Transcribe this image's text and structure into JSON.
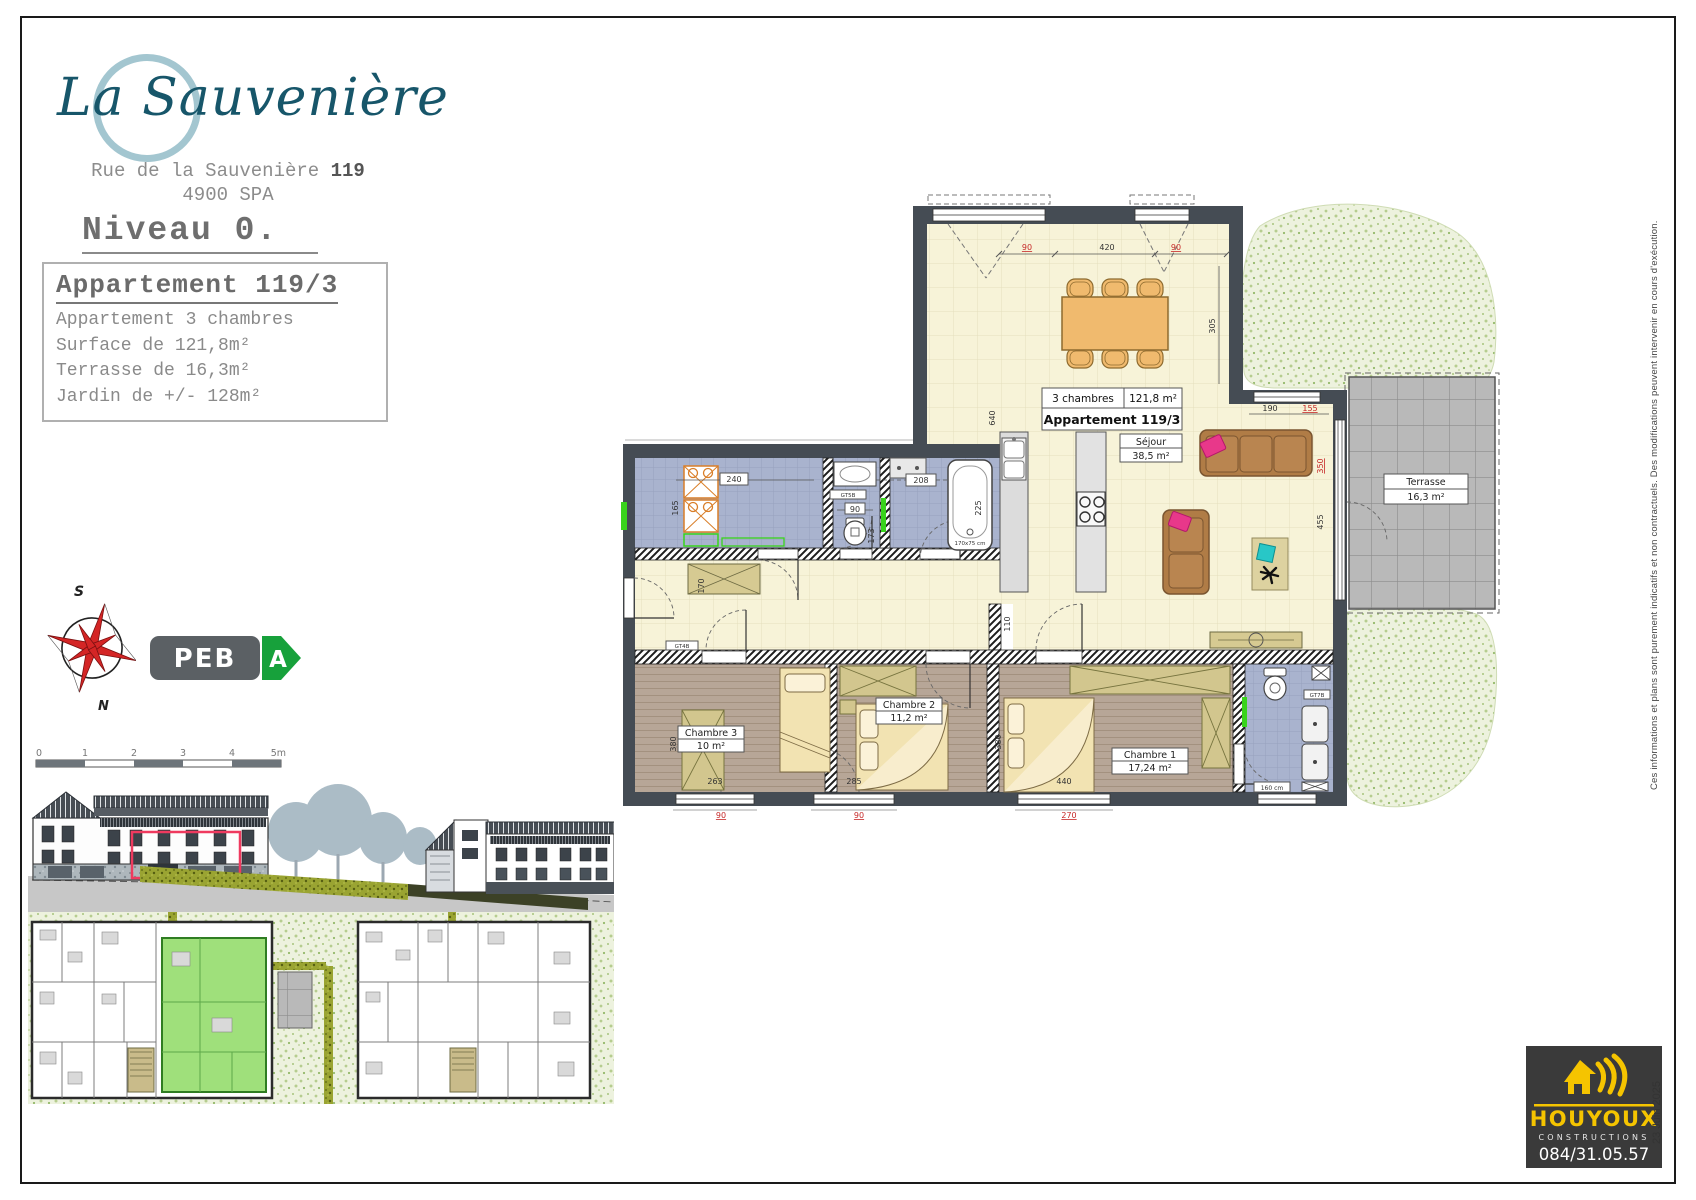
{
  "header": {
    "logo_prefix": "La",
    "logo_suffix": " Sauvenière",
    "address_prefix": "Rue de la Sauvenière ",
    "address_number": "119",
    "address_city": "4900 SPA",
    "level": "Niveau 0."
  },
  "info_box": {
    "title": "Appartement 119/3",
    "line1": "Appartement 3 chambres",
    "line2": "Surface de 121,8m²",
    "line3": "Terrasse de 16,3m²",
    "line4": "Jardin de +/- 128m²"
  },
  "compass": {
    "south": "S",
    "north": "N"
  },
  "peb": {
    "label": "PEB",
    "grade": "A"
  },
  "scale_bar": {
    "t0": "0",
    "t1": "1",
    "t2": "2",
    "t3": "3",
    "t4": "4",
    "t5": "5m"
  },
  "plan": {
    "apartment_box": {
      "type": "3 chambres",
      "area": "121,8 m²",
      "name": "Appartement 119/3"
    },
    "rooms": {
      "sejour": {
        "name": "Séjour",
        "area": "38,5 m²"
      },
      "chambre1": {
        "name": "Chambre 1",
        "area": "17,24 m²"
      },
      "chambre2": {
        "name": "Chambre 2",
        "area": "11,2 m²"
      },
      "chambre3": {
        "name": "Chambre 3",
        "area": "10 m²"
      },
      "terrasse": {
        "name": "Terrasse",
        "area": "16,3 m²"
      }
    },
    "dims": {
      "top_90a": "90",
      "top_420": "420",
      "top_90b": "90",
      "right_305": "305",
      "kitchen_640": "640",
      "laundry_240": "240",
      "laundry_165": "165",
      "wc_90": "90",
      "wc_173": "173",
      "bath_208": "208",
      "bath_225": "225",
      "bath_size": "170x75 cm",
      "hall_170": "170",
      "hall_110": "110",
      "win_190": "190",
      "win_155": "155",
      "glass_350": "350",
      "glass_455": "455",
      "c3_380": "380",
      "c1_380": "380",
      "bottom_263": "263",
      "bottom_90a": "90",
      "bottom_285": "285",
      "bottom_90b": "90",
      "bottom_440": "440",
      "bottom_270": "270",
      "bath2_160": "160 cm"
    },
    "tags": {
      "gt5b": "GT5B",
      "gt4b": "GT4B",
      "gt7b": "GT7B"
    }
  },
  "footer_logo": {
    "name": "HOUYOUX",
    "subtitle": "CONSTRUCTIONS",
    "phone": "084/31.05.57"
  },
  "margin": {
    "disclaimer": "Ces informations et plans sont purement indicatifs et non contractuels.  Des modifications peuvent intervenir en cours d'exécution.",
    "date": "23 Juin 2025"
  },
  "colors": {
    "logo_teal": "#17566a",
    "logo_ring": "#a3c6d0",
    "peb_green": "#17a13b",
    "houyoux_yellow": "#f5c400",
    "dim_red": "#c62828",
    "highlight_red": "#ef3a5f",
    "site_green_unit": "#9fe07b",
    "floor_cream": "#f7f3d8",
    "floor_blue": "#a9b3ce",
    "floor_wood": "#b7a697",
    "wall_dark": "#454c54"
  }
}
